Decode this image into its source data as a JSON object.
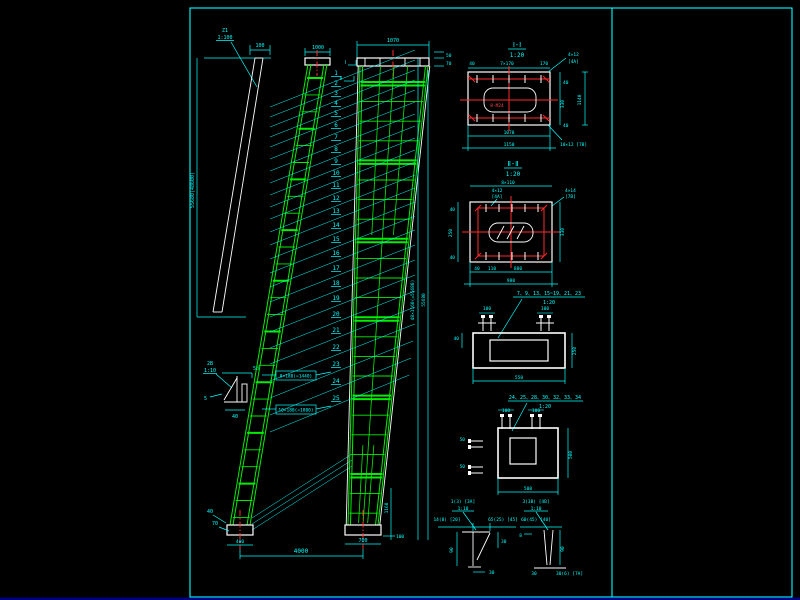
{
  "colors": {
    "background": "#000000",
    "frame": "#00ffff",
    "dimension": "#00ffff",
    "structure": "#ffffff",
    "lattice": "#00ee00",
    "axis": "#ff2a2a"
  },
  "left_view": {
    "label": "Z1",
    "scale": "1:100",
    "top_dim": "100",
    "height_dim": "55680(48600)"
  },
  "tower1": {
    "top_dim": "1000",
    "base_dim": "400",
    "span_dim": "4000",
    "note_a": "8×180(=1440)",
    "note_b": "10×180(=1800)",
    "base_note_a": "40",
    "base_note_b": "70"
  },
  "tower2": {
    "top_dim": "1070",
    "dim_50": "50",
    "dim_70": "70",
    "height_dim": "48×1160(=55680)",
    "height_total": "55680",
    "base_dim": "700",
    "base_dim_b": "100",
    "side_dim": "1160",
    "marker_a": "Ⅰ",
    "marker_b": "Ⅱ"
  },
  "callouts": [
    "1",
    "2",
    "3",
    "4",
    "5",
    "6",
    "7",
    "8",
    "9",
    "10",
    "11",
    "12",
    "13",
    "14",
    "15",
    "16",
    "17",
    "18",
    "19",
    "20",
    "21",
    "22",
    "23",
    "24",
    "25"
  ],
  "gusset": {
    "label": "2B",
    "scale": "1:10",
    "dim_a": "50",
    "dim_b": "40",
    "dim_c": "5"
  },
  "detail1": {
    "title": "Ⅰ-Ⅰ",
    "scale": "1:20",
    "top_left": "40",
    "top_mid": "7×170",
    "top_right": "170",
    "right_a": "40",
    "right_b": "330",
    "right_c": "40",
    "right_total": "1140",
    "bottom_a": "1070",
    "bottom_b": "1150",
    "leader_tr1": "4×12",
    "leader_tr2": "[4A]",
    "leader_br": "10×12 [7B]",
    "note": "8-M24"
  },
  "detail2": {
    "title": "Ⅱ-Ⅱ",
    "scale": "1:20",
    "top_dim": "8×110",
    "leader_l1": "4×12",
    "leader_l2": "[4A]",
    "leader_r1": "4×14",
    "leader_r2": "[7B]",
    "left_a": "40",
    "left_b": "250",
    "left_c": "40",
    "right": "330",
    "bottom_a": "40",
    "bottom_b": "110",
    "bottom_c": "880",
    "bottom_total": "980"
  },
  "detail3": {
    "title": "7、9、13、15~19、21、23",
    "scale": "1:20",
    "bolt_l": "100",
    "bolt_r": "100",
    "left": "40",
    "right": "250",
    "bottom": "550"
  },
  "detail4": {
    "title": "24、25、28、30、32、33、34",
    "scale": "1:20",
    "bolt_l": "100",
    "bolt_r": "100",
    "left_a": "50",
    "left_b": "50",
    "right": "500",
    "bottom": "500"
  },
  "wedge1": {
    "title": "1(3) [3A]",
    "scale": "1:10",
    "dim_l": "14(8) [20]",
    "dim_r": "65(25) [45]",
    "height": "90",
    "right": "30",
    "bottom": "30"
  },
  "wedge2": {
    "title": "3(3B) [4B]",
    "scale": "1:10",
    "dim_top": "60(45) [40]",
    "left": "8",
    "height": "90",
    "bottom_l": "30",
    "bottom_r": "30(6) [7A]"
  }
}
